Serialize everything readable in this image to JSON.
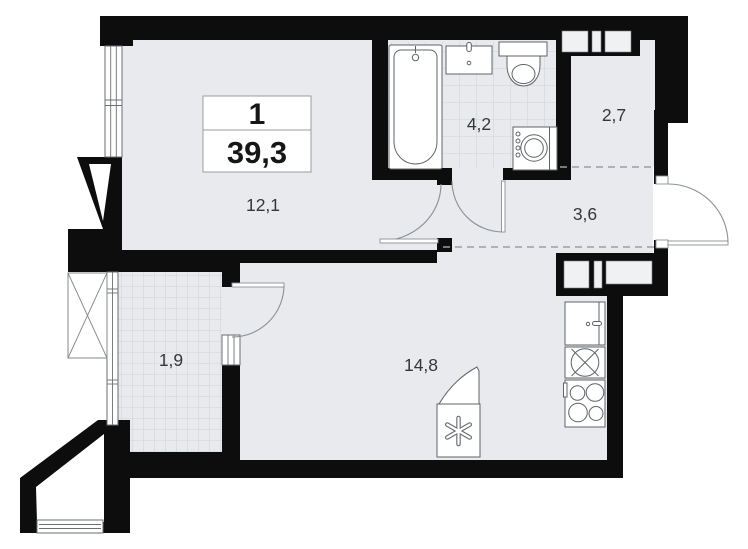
{
  "plan": {
    "type": "apartment-floor-plan",
    "info_box": {
      "rooms_count": "1",
      "total_area": "39,3"
    },
    "rooms": [
      {
        "name": "living-room",
        "area": "12,1"
      },
      {
        "name": "bathroom",
        "area": "4,2"
      },
      {
        "name": "upper-hall",
        "area": "2,7"
      },
      {
        "name": "hallway",
        "area": "3,6"
      },
      {
        "name": "balcony",
        "area": "1,9"
      },
      {
        "name": "kitchen-living-room",
        "area": "14,8"
      }
    ],
    "fixtures": [
      "bathtub",
      "washbasin",
      "toilet",
      "washing-machine",
      "kitchen-cabinet",
      "kitchen-sink",
      "stove",
      "ventilation-box",
      "snowflake-icon",
      "ac-unit-basket"
    ],
    "colors": {
      "wall": "#0d0d0d",
      "floor": "#e8eaed",
      "tile_line": "#c7cbd0",
      "fixture_stroke": "#5f6468",
      "dashed_line": "#9aa0a6",
      "label_text": "#33363a",
      "background": "#ffffff"
    }
  }
}
